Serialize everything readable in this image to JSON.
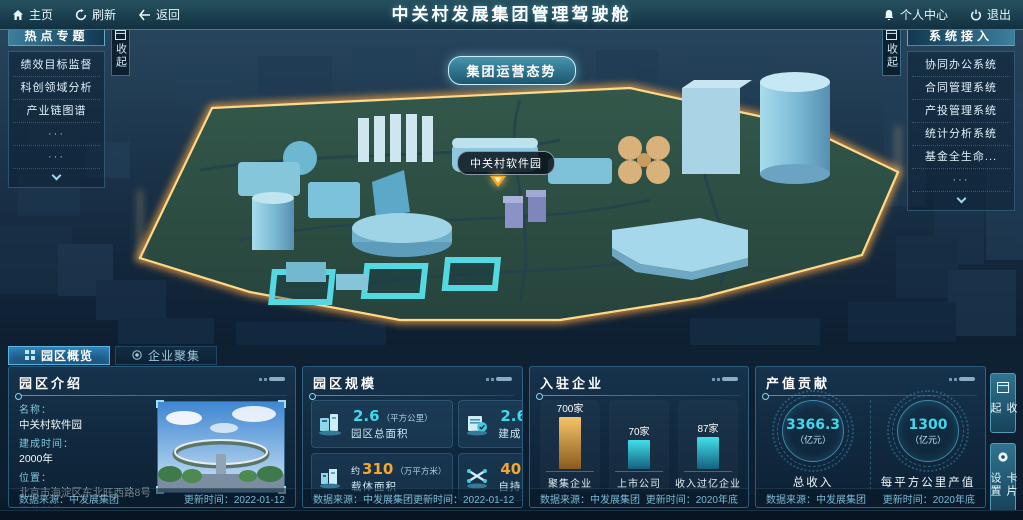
{
  "topbar": {
    "title": "中关村发展集团管理驾驶舱",
    "home": "主页",
    "refresh": "刷新",
    "back": "返回",
    "personal_center": "个人中心",
    "logout": "退出"
  },
  "map": {
    "situation_button": "集团运营态势",
    "park_label": "中关村软件园"
  },
  "left_panel": {
    "title": "热点专题",
    "collapse": "收起",
    "items": [
      "绩效目标监督",
      "科创领域分析",
      "产业链图谱"
    ],
    "dots": "···"
  },
  "right_panel": {
    "title": "系统接入",
    "collapse": "收起",
    "items": [
      "协同办公系统",
      "合同管理系统",
      "产投管理系统",
      "统计分析系统",
      "基金全生命..."
    ],
    "dots": "···"
  },
  "tabs": [
    {
      "label": "园区概览"
    },
    {
      "label": "企业聚集"
    }
  ],
  "panels": {
    "intro": {
      "title": "园区介绍",
      "fields": [
        {
          "label": "名称：",
          "value": "中关村软件园"
        },
        {
          "label": "建成时间：",
          "value": "2000年"
        },
        {
          "label": "位置：",
          "value": "北京市海淀区东北旺西路8号"
        },
        {
          "label": "运营单位：",
          "value": "北京中关村软件园发展有限公司"
        }
      ],
      "source": "数据来源：中发展集团",
      "updated": "更新时间：2022-01-12"
    },
    "scale": {
      "title": "园区规模",
      "stats": [
        {
          "prefix": "",
          "value": "2.6",
          "unit": "（平方公里）",
          "label": "园区总面积",
          "color": "cyan"
        },
        {
          "prefix": "",
          "value": "2.6",
          "unit": "（平方公里）",
          "label": "建成区面积",
          "color": "cyan"
        },
        {
          "prefix": "约",
          "value": "310",
          "unit": "（万平方米）",
          "label": "载体面积",
          "color": "orange"
        },
        {
          "prefix": "",
          "value": "40",
          "unit": "（万平方米）",
          "label": "自持面积",
          "color": "orange"
        }
      ],
      "source": "数据来源：中发展集团",
      "updated": "更新时间：2022-01-12"
    },
    "enterprises": {
      "title": "入驻企业",
      "source": "数据来源：中发展集团",
      "updated": "更新时间：2020年底"
    },
    "output": {
      "title": "产值贡献",
      "gauges": [
        {
          "value": "3366.3",
          "unit": "（亿元）",
          "label": "总收入"
        },
        {
          "value": "1300",
          "unit": "（亿元）",
          "label": "每平方公里产值"
        }
      ],
      "source": "数据来源：中发展集团",
      "updated": "更新时间：2020年底"
    }
  },
  "chart_data": {
    "type": "bar",
    "title": "入驻企业",
    "categories": [
      "聚集企业",
      "上市公司",
      "收入过亿企业"
    ],
    "values": [
      700,
      70,
      87
    ],
    "value_labels": [
      "700家",
      "70家",
      "87家"
    ],
    "unit": "家",
    "ylim": [
      0,
      700
    ],
    "grid": false,
    "bar_gradients": [
      [
        "#f5c569",
        "#8a5a1e"
      ],
      [
        "#41e0ea",
        "#16607f"
      ],
      [
        "#41e0ea",
        "#16607f"
      ]
    ]
  },
  "side_buttons": {
    "collapse": "收起",
    "card_settings": "卡片设置"
  },
  "colors": {
    "accent_cyan": "#3fd9ec",
    "accent_orange": "#f5a62c",
    "park_border_glow": "#f7b24a",
    "park_fill": "#2e4d3f"
  }
}
